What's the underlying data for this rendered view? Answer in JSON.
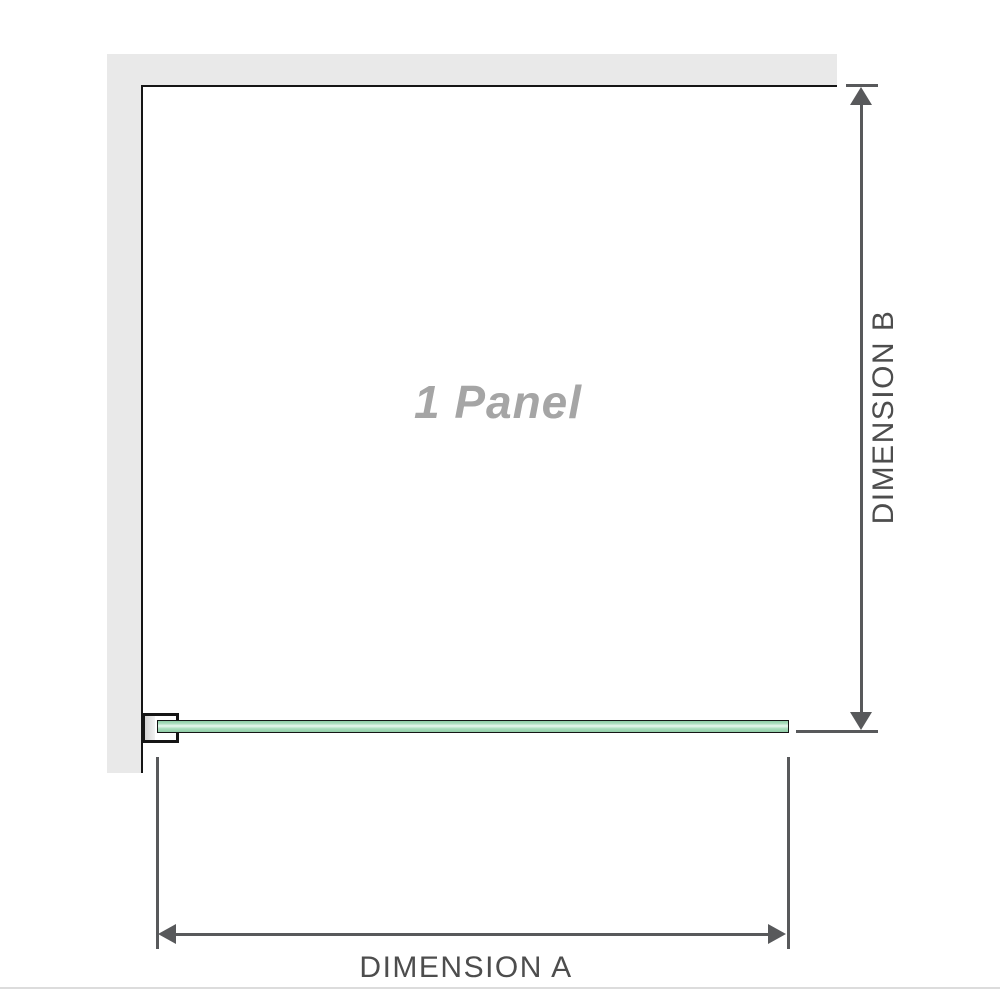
{
  "diagram": {
    "panel_label": "1 Panel",
    "dimension_a_label": "DIMENSION A",
    "dimension_b_label": "DIMENSION B"
  },
  "colors": {
    "wall": "#e9e9e9",
    "outline": "#151515",
    "dimension-line": "#58595b",
    "label-text": "#4d4d4d",
    "panel-label-text": "#a5a5a5",
    "glass-light": "#e9f8ef",
    "glass-mid": "#a9ddbc",
    "glass-dark": "#8fcda6",
    "divider": "#dcdcdc",
    "bracket-shade": "#d2d2d2"
  }
}
